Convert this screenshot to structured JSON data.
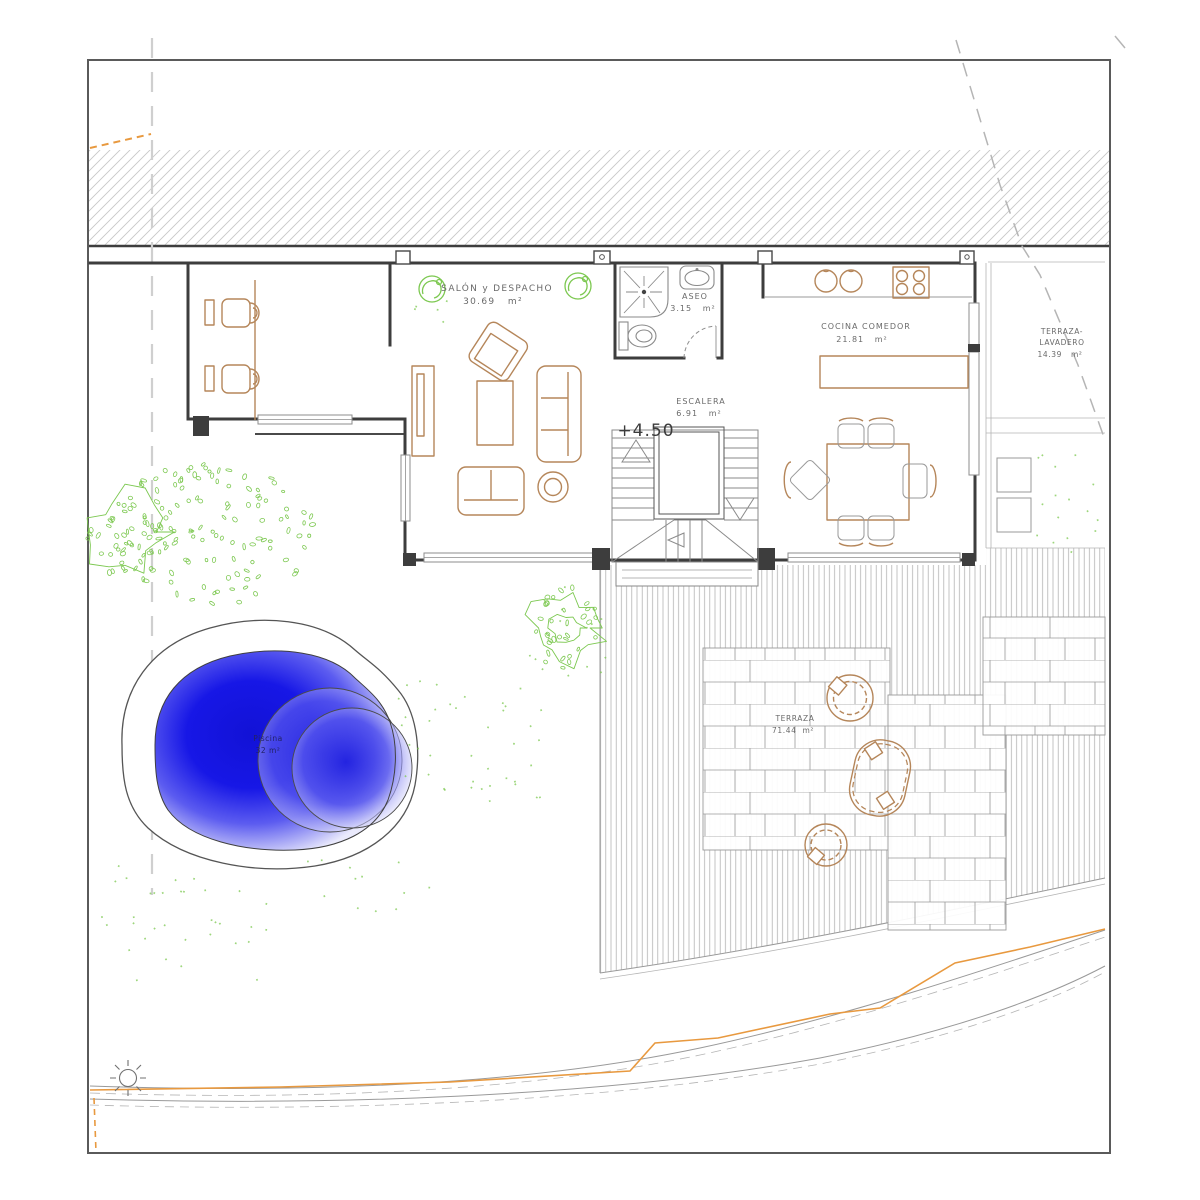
{
  "drawing": {
    "kind": "architectural-floor-plan",
    "level_marker": "+4.50",
    "rooms": {
      "salon": {
        "name": "SALÓN y DESPACHO",
        "area": "30.69   m²"
      },
      "aseo": {
        "name": "ASEO",
        "area": "3.15   m²"
      },
      "cocina": {
        "name": "COCINA COMEDOR",
        "area": "21.81   m²"
      },
      "escalera": {
        "name": "ESCALERA",
        "area": "6.91   m²"
      },
      "terraza_lavadero": {
        "name_line1": "TERRAZA-",
        "name_line2": "LAVADERO",
        "area": "14.39   m²"
      },
      "terraza": {
        "name": "TERRAZA",
        "area": "71.44  m²"
      },
      "piscina": {
        "name": "Piscina",
        "area": "32 m²"
      }
    },
    "icons": {
      "sun": "sun-symbol"
    },
    "colors": {
      "wall": "#3d3d3d",
      "thin_line": "#999999",
      "furniture": "#b5865a",
      "vegetation": "#7cc850",
      "contour_orange": "#e8993f",
      "pool_deep": "#1414dd",
      "pool_light": "#eaeafc",
      "label": "#6a6a6a"
    }
  }
}
